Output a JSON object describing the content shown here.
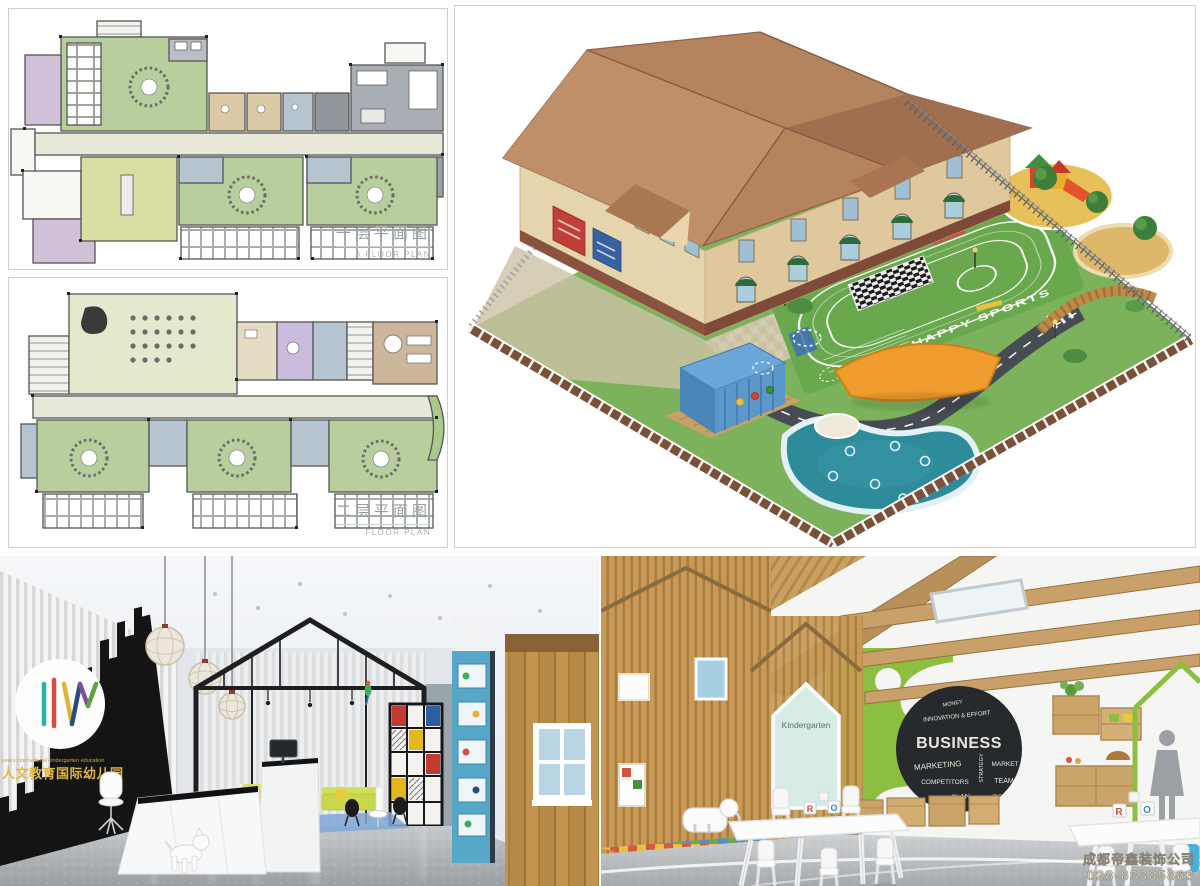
{
  "floor_plans": {
    "first": {
      "title_cn": "一层平面图",
      "title_en": "A FLOOR PLAN"
    },
    "second": {
      "title_cn": "二层平面图",
      "title_en": "FLOOR PLAN"
    }
  },
  "site_render": {
    "field_text": "HAPPY SPORTS"
  },
  "lobby_render": {
    "logo_en": "years international kindergarten education",
    "logo_cn": "人文教育国际幼儿园"
  },
  "classroom_render": {
    "door_sign": "Kindergarten",
    "chalkboard": {
      "top": "MONEY",
      "arc": "INNOVATION & EFFORT",
      "main": "BUSINESS",
      "w1": "MARKETING",
      "w2": "MARKET",
      "w3": "COMPETITORS",
      "w4": "TEAM",
      "w5": "PLAN",
      "w6": "STRATEGY",
      "w7": "IDEA"
    },
    "blocks": {
      "r": "R",
      "o": "O"
    },
    "watermark_company": "成都帝鑫装饰公司",
    "watermark_phone": "028-83385863"
  },
  "colors": {
    "roof": "#b5835e",
    "wall_cream": "#e6d4ac",
    "grass": "#7cb25b",
    "pool": "#2e8b9a",
    "container_blue": "#5b97c8",
    "accent_green_wall": "#8cbf3f",
    "wood": "#c89a55",
    "gold_logo": "#e0b83f",
    "track_green": "#69a84d"
  }
}
